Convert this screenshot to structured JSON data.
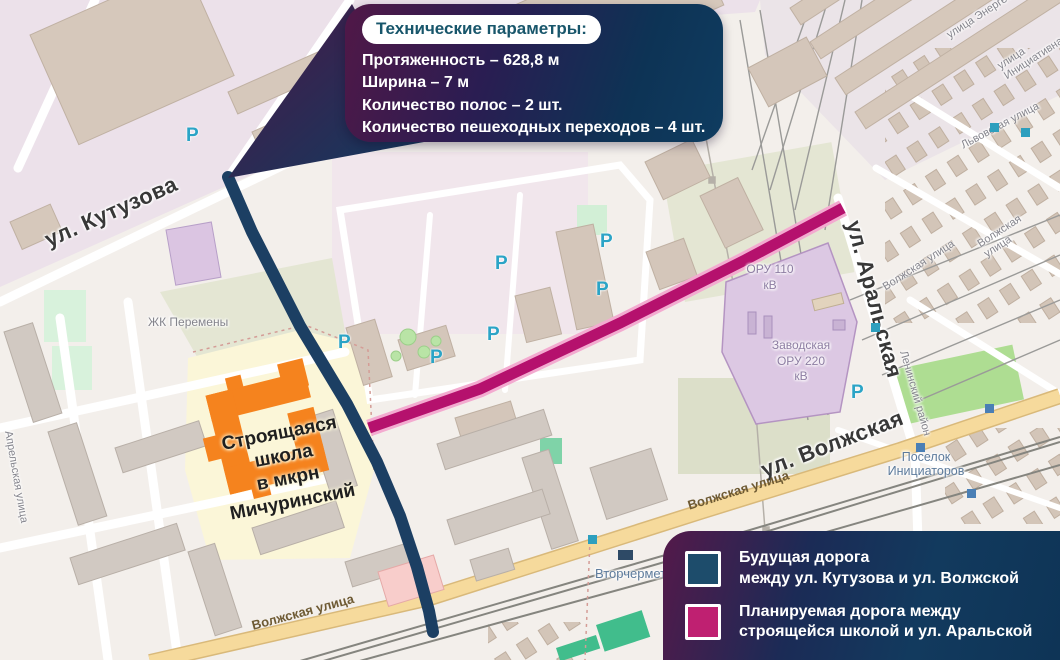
{
  "callout": {
    "title": "Технические параметры:",
    "lines": "Протяженность – 628,8 м\nШирина – 7 м\nКоличество полос – 2 шт.\nКоличество пешеходных переходов – 4 шт."
  },
  "legend": {
    "items": [
      {
        "color": "#1d4c6b",
        "label": "Будущая дорога\nмежду ул. Кутузова и ул. Волжской"
      },
      {
        "color": "#bf2071",
        "label": "Планируемая дорога между\nстроящейся школой и ул. Аральской"
      }
    ]
  },
  "map": {
    "streets": {
      "kutuzova": "ул. Кутузова",
      "aralskaya": "ул. Аральская",
      "volzhskaya_big": "ул. Волжская",
      "volzhskaya_street": "Волжская улица",
      "energetikov": "улица Энергетиков",
      "initsiativnaya": "улица Инициативная",
      "lvovskaya": "Львовская улица",
      "aprelskaya": "Апрельская улица"
    },
    "areas": {
      "school": "Строящаяся\nшкола\nв мкрн\nМичуринский",
      "zhk": "ЖК Перемены",
      "oru110": "ОРУ 110\nкВ",
      "zavodskaya": "Заводская\nОРУ 220\nкВ",
      "vtorchermet": "Вторчермет",
      "poselok": "Поселок\nИнициаторов",
      "leninsky": "Ленинский район"
    },
    "parking_label": "P"
  },
  "colors": {
    "future_road": "#1c3f63",
    "planned_road": "#b5116d",
    "school_building": "#f5831e",
    "substation_fill": "#dcc8e3",
    "map_background": "#f3efeb"
  }
}
